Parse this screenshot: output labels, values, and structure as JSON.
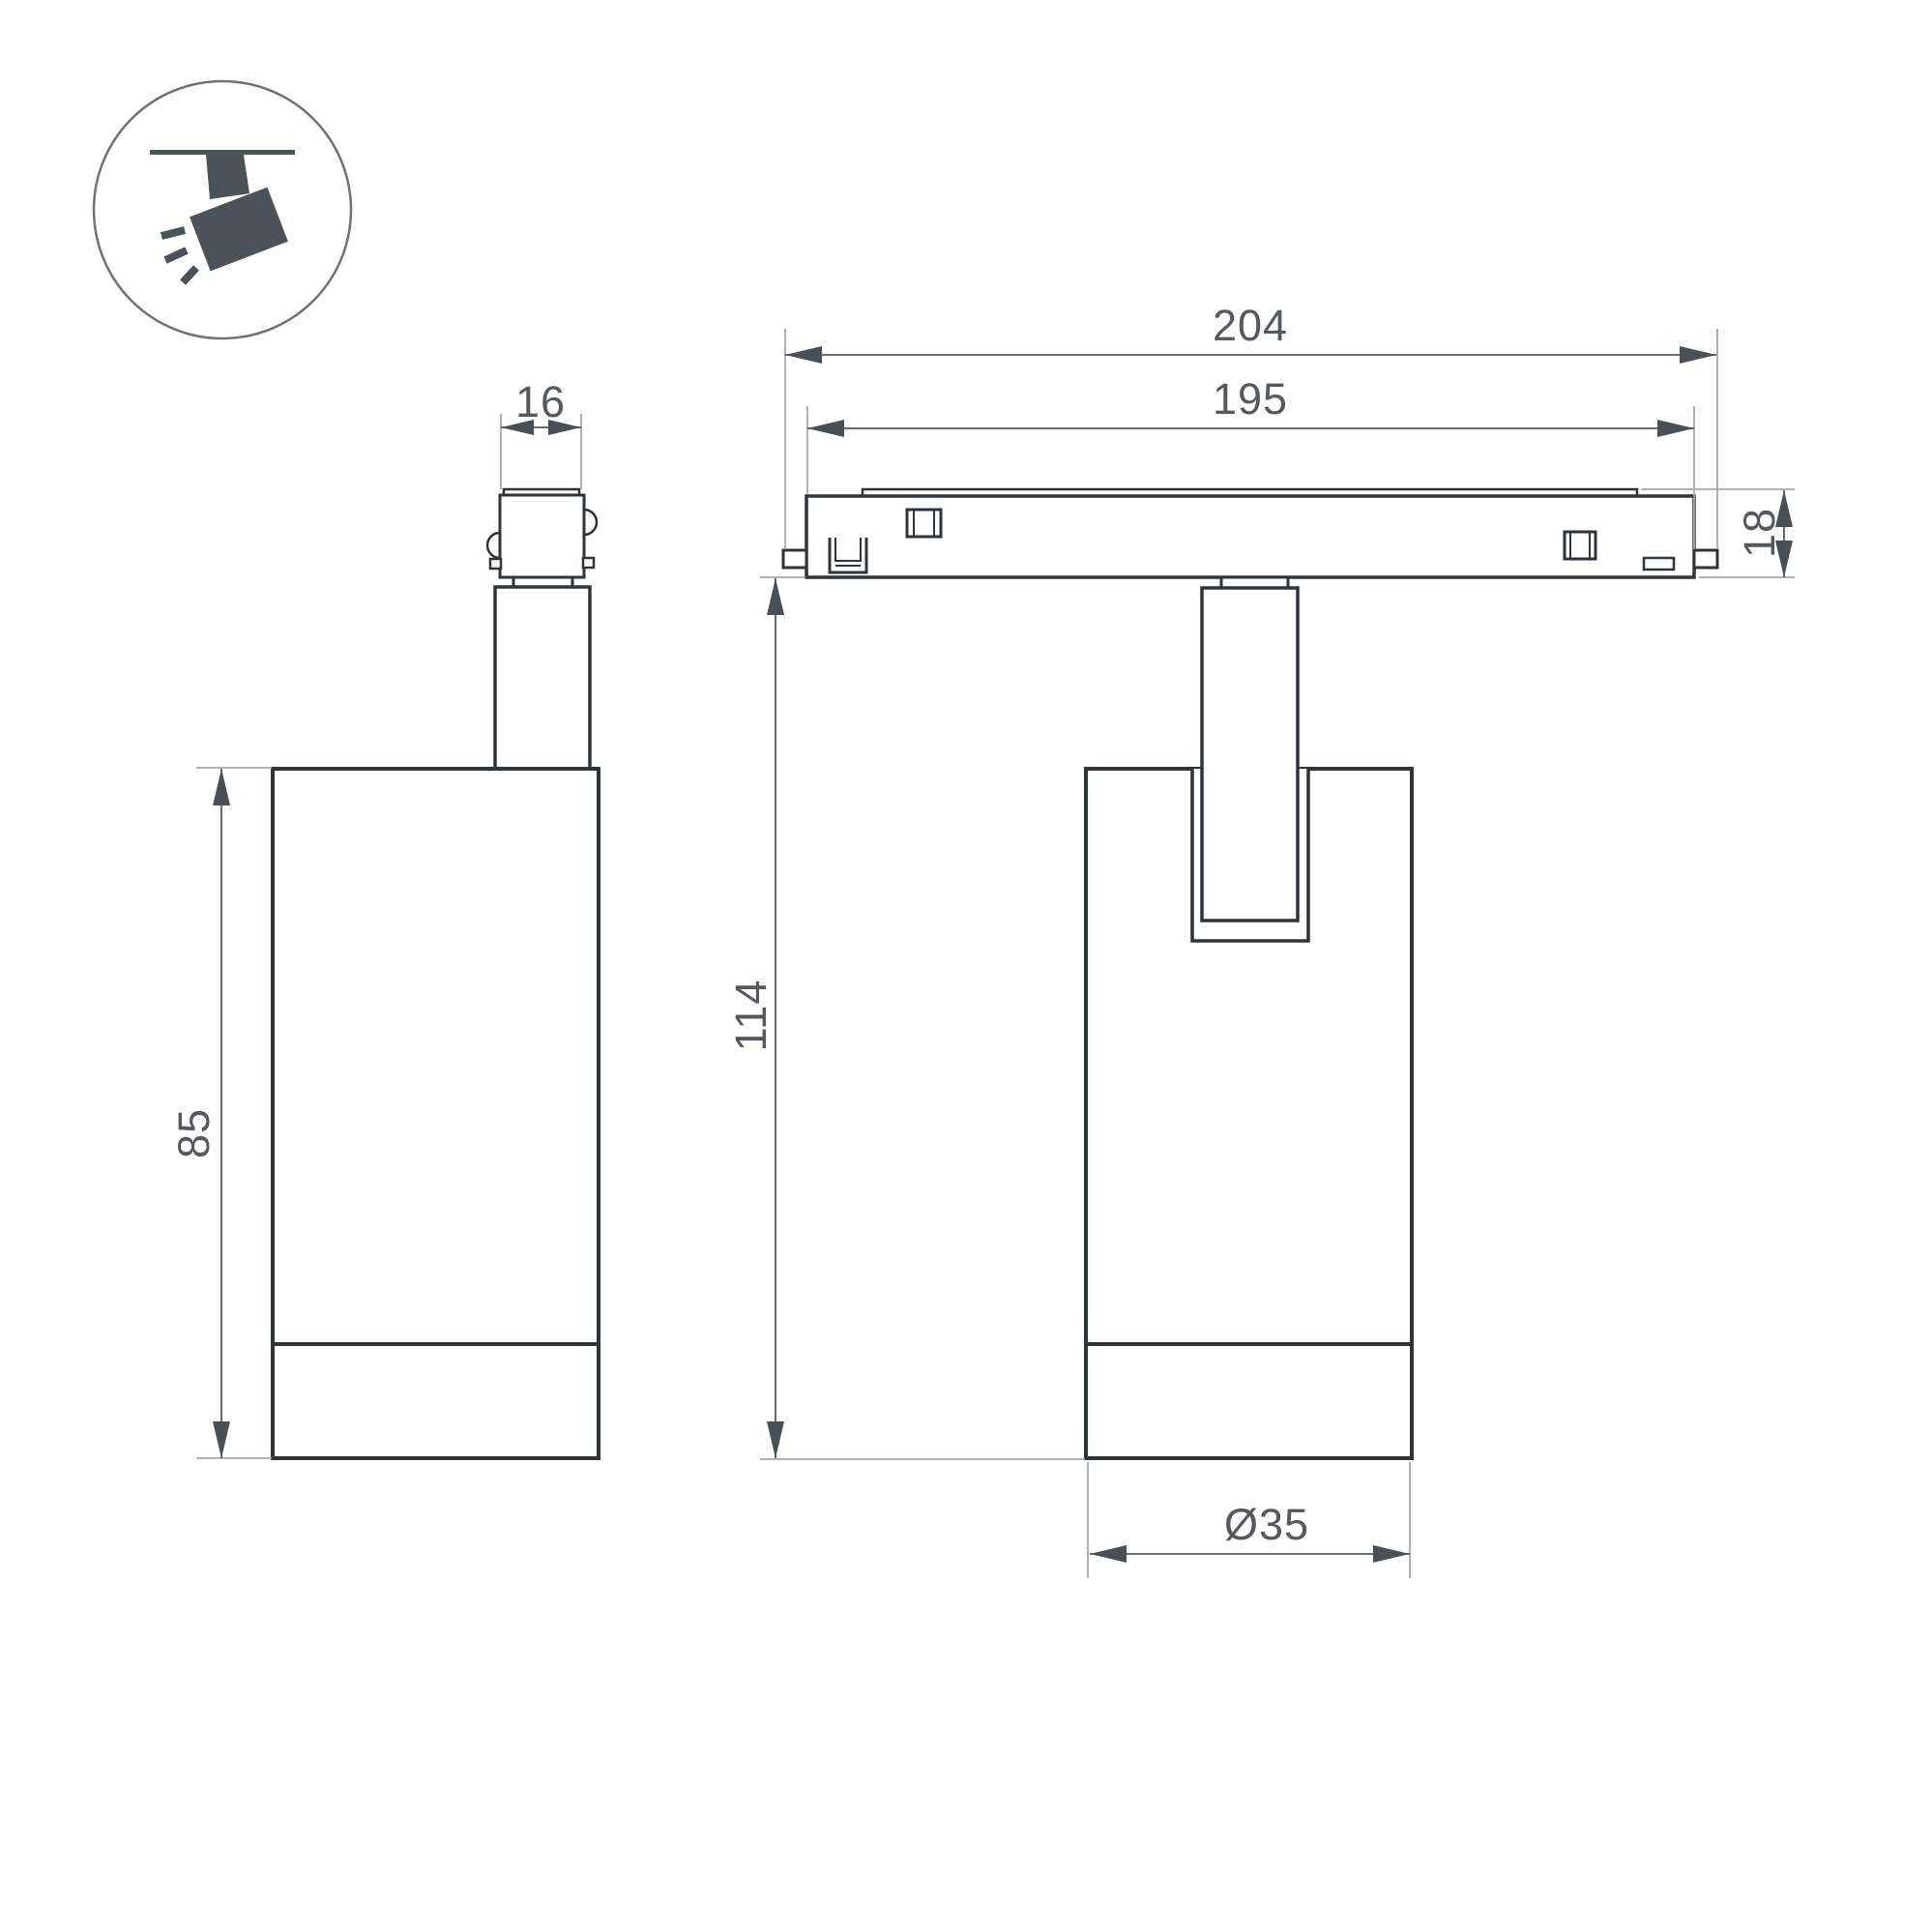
{
  "drawing": {
    "title": "track-spotlight-dimension-drawing",
    "views": {
      "side_view": "spotlight side view with track adapter",
      "front_view": "spotlight on track front view"
    },
    "dimensions": {
      "adapter_width": "16",
      "track_length": "204",
      "track_window_length": "195",
      "track_height": "18",
      "body_height": "85",
      "overall_height": "114",
      "body_diameter": "Ø35"
    },
    "icon": {
      "name": "track-spotlight-pictogram",
      "description": "ceiling track with tilted spotlight emitting rays"
    },
    "colors": {
      "background": "#ffffff",
      "outline": "#2f343a",
      "dimension_text": "#55595e",
      "dimension_line": "#55595e",
      "extension_line": "#a6a9ac",
      "icon_fill": "#4b525a"
    }
  }
}
